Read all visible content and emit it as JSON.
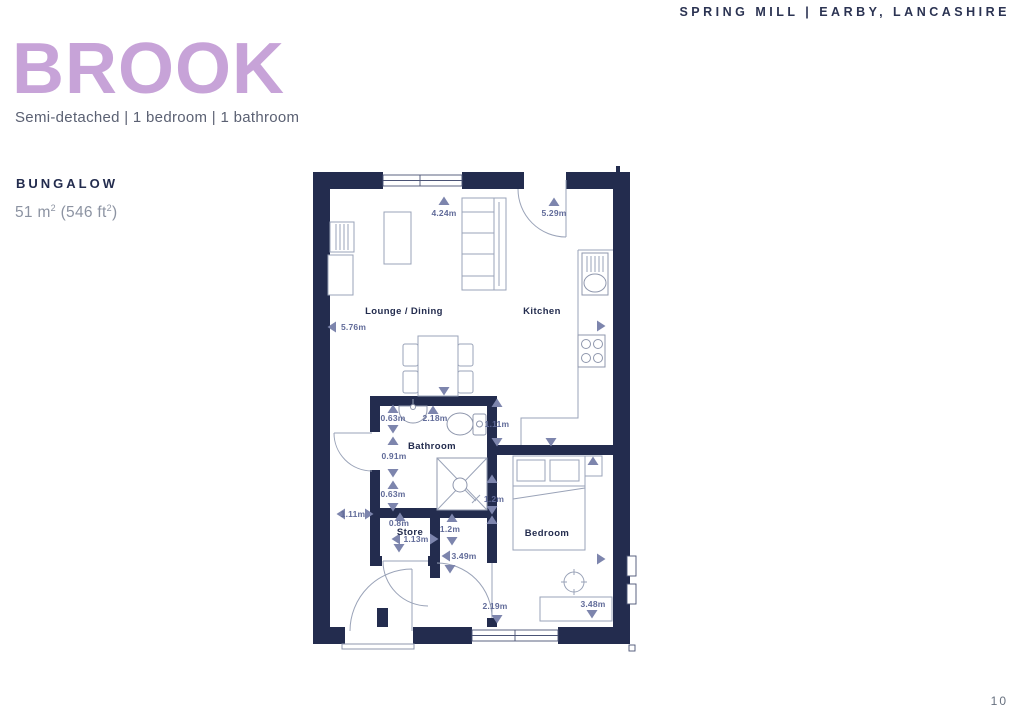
{
  "header": {
    "location": "SPRING MILL  |  EARBY, LANCASHIRE"
  },
  "title": "BROOK",
  "subtitle": "Semi-detached  |  1 bedroom  |  1 bathroom",
  "spec": {
    "type_label": "BUNGALOW",
    "area_prefix": "51 m",
    "area_sup_1": "2",
    "area_mid": " (546 ft",
    "area_sup_2": "2",
    "area_suffix": ")"
  },
  "page_number": "10",
  "colors": {
    "title_accent": "#c7a3d8",
    "wall_navy": "#232c4e",
    "dimension_text": "#616b99",
    "arrow": "#7d85ad"
  },
  "floorplan": {
    "rooms": {
      "lounge_dining": "Lounge / Dining",
      "kitchen": "Kitchen",
      "bathroom": "Bathroom",
      "store": "Store",
      "bedroom": "Bedroom"
    },
    "dimensions": {
      "lounge_depth": "4.24m",
      "kitchen_depth": "5.29m",
      "open_plan_width": "5.76m",
      "bathroom_seg_top": "0.63m",
      "bathroom_width": "2.18m",
      "kitchen_passage": "1.11m",
      "bathroom_seg_mid": "0.91m",
      "bathroom_seg_bottom": "0.63m",
      "hall_width": "1.11m",
      "store_depth": "0.8m",
      "store_width": "1.13m",
      "bedroom_recess": "1.2m",
      "hall_recess": "1.2m",
      "hall_length": "3.49m",
      "entry_width": "2.19m",
      "bedroom_width": "3.48m"
    }
  }
}
